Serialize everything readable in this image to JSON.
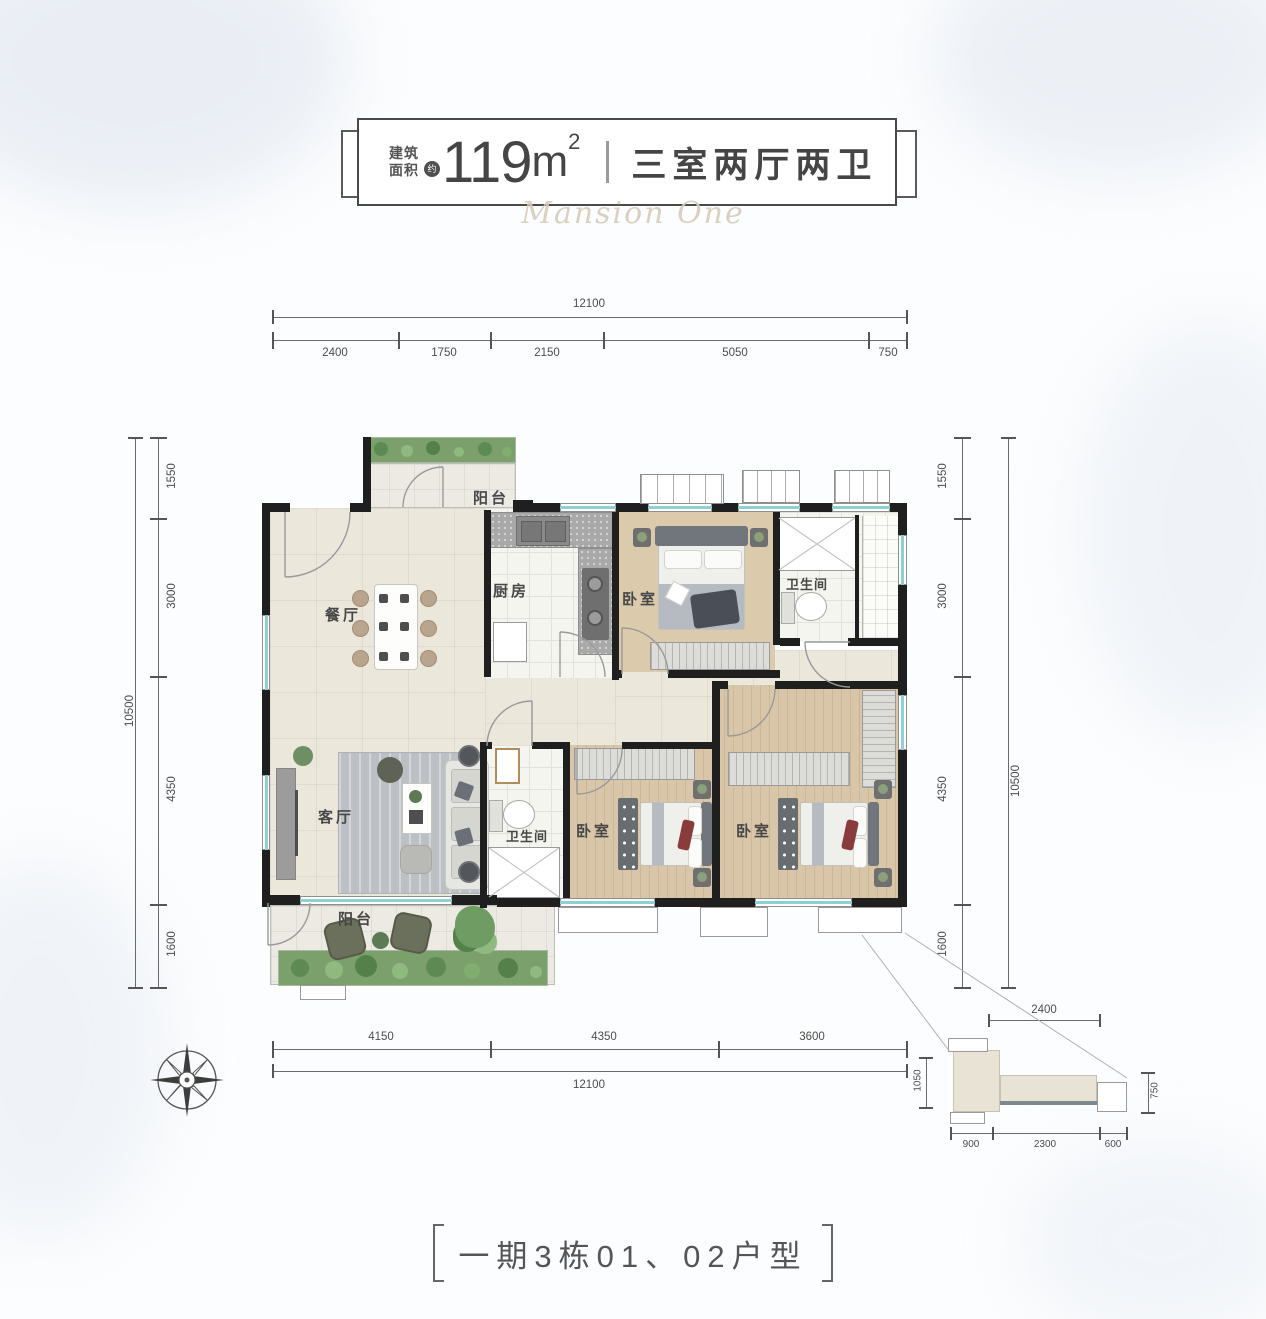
{
  "header": {
    "area_label_l1": "建筑",
    "area_label_l2": "面积",
    "approx": "约",
    "value": "119",
    "unit": "m",
    "sup": "2",
    "sep": "",
    "type_text": "三室两厅两卫",
    "watermark": "Mansion One"
  },
  "dims": {
    "top_total": "12100",
    "top_segs": [
      "2400",
      "1750",
      "2150",
      "5050",
      "750"
    ],
    "left_total": "10500",
    "left_segs": [
      "1550",
      "3000",
      "4350",
      "1600"
    ],
    "right_total": "10500",
    "right_segs": [
      "1550",
      "3000",
      "4350",
      "1600"
    ],
    "bottom_segs": [
      "4150",
      "4350",
      "3600"
    ],
    "bottom_total": "12100",
    "detail_top": "2400",
    "detail_left": "1050",
    "detail_right": "750",
    "detail_bottom_segs": [
      "900",
      "2300",
      "600"
    ]
  },
  "rooms": {
    "balcony_top": "阳台",
    "kitchen": "厨房",
    "bedroom_top": "卧室",
    "bath_top": "卫生间",
    "dining": "餐厅",
    "living": "客厅",
    "bath_mid": "卫生间",
    "bedroom_mid": "卧室",
    "bedroom_right": "卧室",
    "balcony_bottom": "阳台"
  },
  "footer": {
    "caption": "一期3栋01、02户型"
  },
  "colors": {
    "wall": "#1f1f1f",
    "wood_floor": "#d9c6a8",
    "cream_floor": "#ece7db",
    "tile_floor": "#f5f5f0",
    "balcony_floor": "#eceae3",
    "window_glass": "#8fd0d4",
    "greenery": "#6f9c63",
    "title_text": "#454545"
  }
}
